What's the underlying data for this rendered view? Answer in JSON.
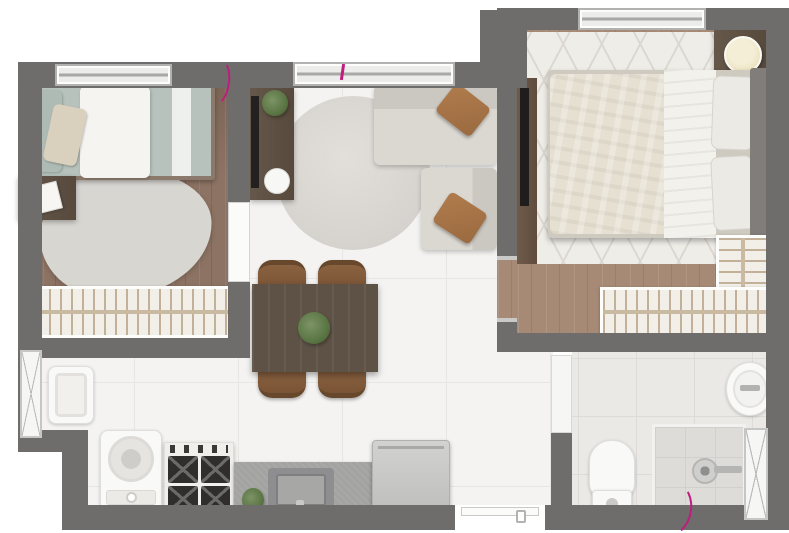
{
  "image_type": "apartment floor plan – rendered top-down view, no text labels",
  "palette": {
    "wall": "#6e6d6b",
    "outside": "#ffffff",
    "wood_floor_bedroom1": "#8d7363",
    "wood_floor_master": "#a68a76",
    "tile_floor": "#f4f3f1",
    "bath_tile": "#ebe9e6",
    "rug_gray": "#d8d6d1",
    "rug_diamond": "#efede8",
    "sofa": "#d7d4ce",
    "pillow_accent": "#a9744a",
    "bedding_sage": "#b7c2bc",
    "bedding_cream": "#e6e0d2",
    "dark_wood_furniture": "#5e5145",
    "chair_wood": "#8a6240",
    "counter": "#a3a3a1",
    "appliance_white": "#f2f1ee",
    "fridge_gray": "#c6c6c4",
    "annotation_magenta": "#bf1d7d",
    "lamp_cream": "#eadfb8",
    "plant_green": "#55703f"
  },
  "rooms": [
    {
      "id": "bedroom-1",
      "floor": "wood",
      "furniture": [
        "single-bed",
        "desk-with-book",
        "organic-rug",
        "wardrobe-with-hangers",
        "window"
      ]
    },
    {
      "id": "living-room",
      "floor": "tile",
      "furniture": [
        "tv-sideboard",
        "tv",
        "plant",
        "speaker",
        "round-rug",
        "l-shaped-sofa",
        "two-brown-pillows",
        "balcony-window"
      ]
    },
    {
      "id": "dining-kitchen",
      "floor": "tile",
      "furniture": [
        "dining-table",
        "four-chairs",
        "table-plant",
        "washing-machine",
        "gas-stove",
        "countertop-with-sink",
        "counter-plant",
        "refrigerator",
        "laundry-tub",
        "laundry-window",
        "entrance-door"
      ]
    },
    {
      "id": "master-bedroom",
      "floor": "wood",
      "furniture": [
        "double-bed",
        "two-pillows",
        "headboard",
        "nightstand",
        "round-lamp",
        "diamond-rug",
        "tv-panel",
        "l-shaped-closet",
        "window"
      ]
    },
    {
      "id": "bathroom",
      "floor": "tile",
      "furniture": [
        "toilet",
        "round-sink",
        "shower-area",
        "shower-head",
        "hatched-window",
        "door"
      ]
    }
  ],
  "annotations": {
    "magenta_marks": 3,
    "description": "magenta door-swing arc at bedroom-1 door, tick at living-room window, arc at bathroom bottom wall",
    "color": "#bf1d7d"
  },
  "doors": [
    "bedroom-1-door-leaf",
    "master-bedroom-doorway",
    "bathroom-door-leaf",
    "entrance-door-open"
  ],
  "windows_count": 5
}
